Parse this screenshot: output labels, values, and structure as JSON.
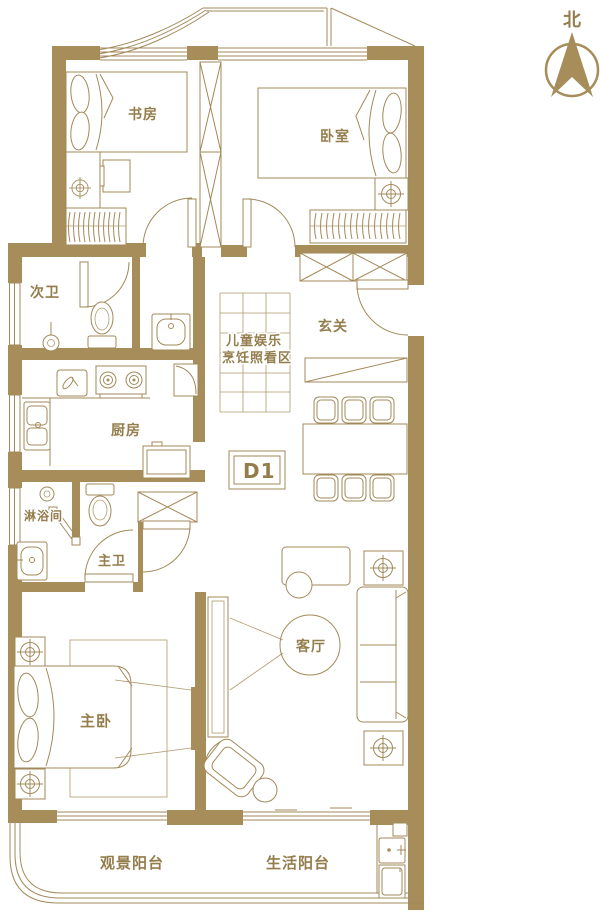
{
  "plan": {
    "title_semantic": "apartment floor plan",
    "unit_label": "D1",
    "compass": {
      "north_label": "北"
    },
    "rooms": {
      "study": "书房",
      "bedroom": "卧室",
      "second_bath": "次卫",
      "foyer": "玄关",
      "kitchen": "厨房",
      "shower_room": "淋浴间",
      "master_bath": "主卫",
      "master_bedroom": "主卧",
      "living_room": "客厅",
      "view_balcony": "观景阳台",
      "service_balcony": "生活阳台"
    },
    "play_area": {
      "line1": "儿童娱乐",
      "line2": "烹饪照看区"
    },
    "colors": {
      "line": "#a2895a",
      "wall": "#a68d5a",
      "text": "#947d4c",
      "background": "#ffffff"
    }
  }
}
